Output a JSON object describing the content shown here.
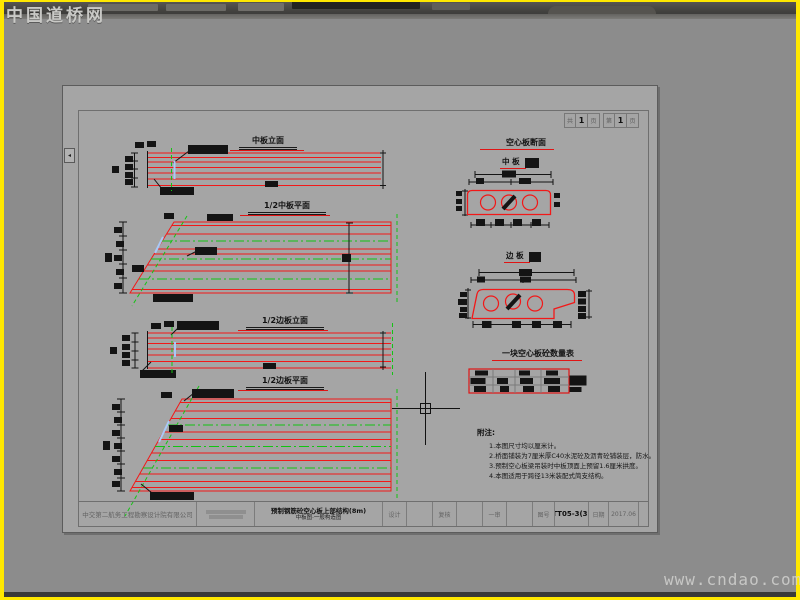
{
  "watermarks": {
    "brand": "中国道桥网",
    "url": "www.cndao.com"
  },
  "sheet": {
    "page_info": {
      "g1": [
        "共",
        "1",
        "页"
      ],
      "g2": [
        "第",
        "1",
        "页"
      ]
    },
    "titles": {
      "d1": "中板立面",
      "d2": "1/2中板平面",
      "d3": "1/2边板立面",
      "d4": "1/2边板平面",
      "sections": "空心板断面",
      "mid_slab": "中 板",
      "edge_slab": "边 板",
      "table": "一块空心板砼数量表"
    },
    "notes": {
      "heading": "附注:",
      "lines": [
        "1.本图尺寸均以厘米计。",
        "2.桥面铺装为7厘米厚C40水泥砼及沥青砼铺装层，防水。",
        "3.预制空心板梁吊装时中板顶面上预留1.6厘米拱度。",
        "4.本图适用于跨径13米装配式简支结构。"
      ]
    },
    "titleblock": {
      "company": "中交第二航务工程勘察设计院有限公司",
      "project_line1": "预制钢筋砼空心板上部结构(8m)",
      "project_line2": "中板图·一般构造图",
      "design_label": "设计",
      "check_label": "复核",
      "review_label": "一审",
      "figno_label": "图号",
      "figno_value": "TT05-3(3)",
      "date_label": "日期",
      "date_value": "2017.06"
    }
  }
}
